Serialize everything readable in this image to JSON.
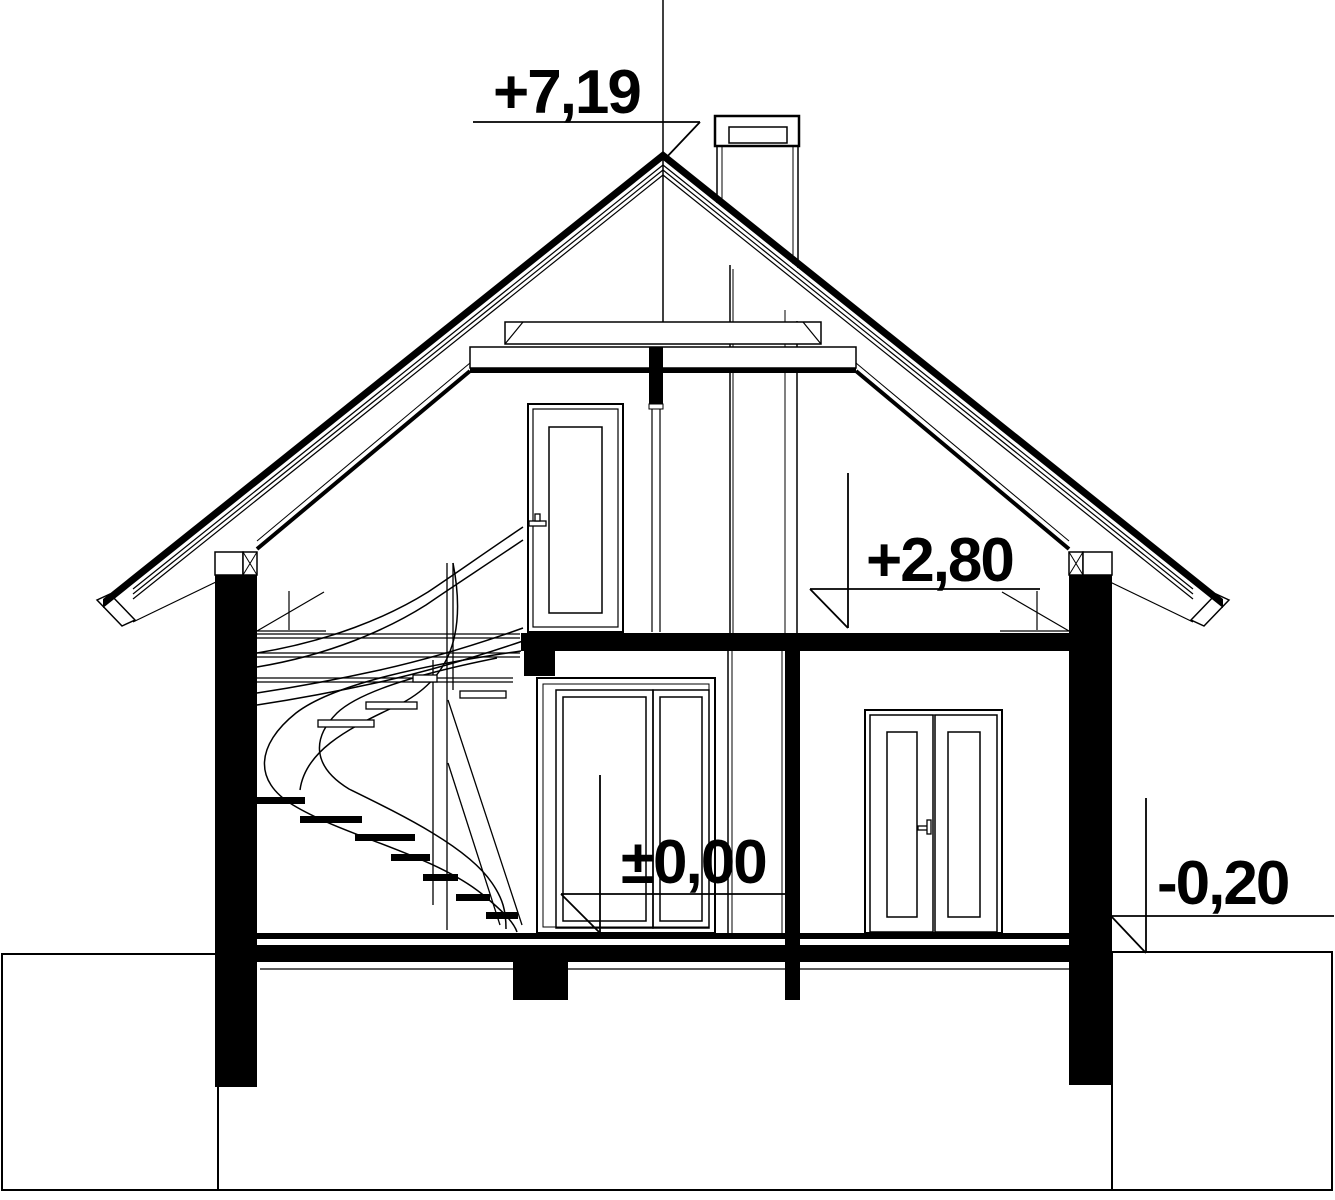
{
  "drawing": {
    "title": "house-cross-section",
    "levels": {
      "ridge": "+7,19",
      "floor1": "+2,80",
      "ground": "±0,00",
      "terrain": "-0,20"
    },
    "colors": {
      "line": "#000000",
      "background": "#ffffff"
    }
  }
}
